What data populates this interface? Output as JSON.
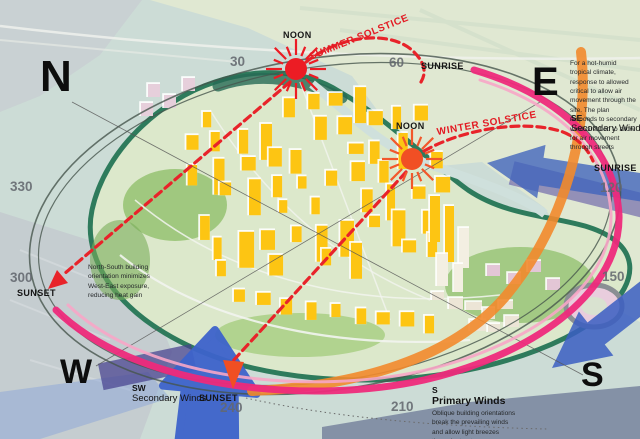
{
  "compass": {
    "n": "N",
    "e": "E",
    "s": "S",
    "w": "W"
  },
  "sun_path": {
    "noon_summer": "NOON",
    "noon_winter": "NOON",
    "summer_solstice": "SUMMER SOLSTICE",
    "winter_solstice": "WINTER SOLSTICE",
    "sunrise_east": "SUNRISE",
    "sunrise_southeast": "SUNRISE",
    "sunset_west": "SUNSET",
    "sunset_southwest": "SUNSET",
    "degrees": [
      "30",
      "60",
      "120",
      "150",
      "210",
      "240",
      "300",
      "330"
    ]
  },
  "winds": {
    "se": {
      "abbr": "SE",
      "label": "Secondary Winds"
    },
    "sw": {
      "abbr": "SW",
      "label": "Secondary Winds"
    },
    "s": {
      "abbr": "S",
      "label": "Primary Winds",
      "note": "Oblique building orientations break the prevailing winds and allow light breezes through streets"
    }
  },
  "notes": {
    "climate": "For a hot-humid tropical climate, response to allowed critical to allow air movement through the site. The plan responds to secondary wind direction to allow for air movement through streets",
    "orientation": "North-South building orientation minimizes West-East exposure, reducing heat gain"
  },
  "icons": {
    "summer_sun": "sun-icon",
    "winter_sun": "sun-icon",
    "se_wind": "wind-arrow-icon",
    "s_wind": "wind-arrow-icon",
    "sw_wind": "wind-arrow-icon",
    "sunset_west_arrow": "arrowhead-icon",
    "sunset_southwest_arrow": "arrowhead-icon"
  },
  "colors": {
    "solstice_red": "#e8232a",
    "sun_summer": "#ec1c24",
    "sun_winter": "#f14f24",
    "wind_blue": "#3d63cb",
    "sun_path_pink": "#ee2a7b",
    "sun_path_orange": "#f28a2c"
  }
}
